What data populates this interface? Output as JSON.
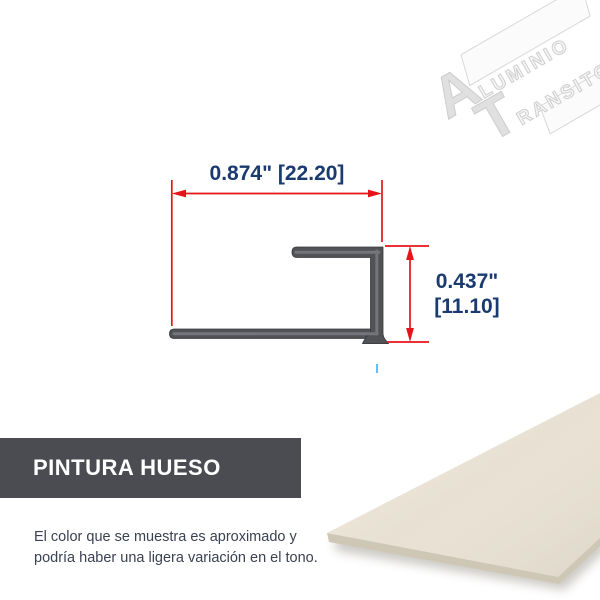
{
  "brand": {
    "name": "Aluminio Transito",
    "logo_line1_initial": "A",
    "logo_line1_rest": "LUMINIO",
    "logo_line2_initial": "T",
    "logo_line2_rest": "RANSITO",
    "registered_mark": "®",
    "watermark_color": "#dcdcdc"
  },
  "drawing": {
    "type": "profile-cross-section",
    "width_label": "0.874\" [22.20]",
    "height_label_line1": "0.437\"",
    "height_label_line2": "[11.10]",
    "dimension_color": "#e41418",
    "label_color": "#1a3a70",
    "profile_color": "#515256",
    "profile_highlight_color": "#7b7c81",
    "centerline_color": "#44b0e8"
  },
  "finish": {
    "banner_label": "PINTURA HUESO",
    "banner_color": "#4a4c52",
    "banner_text_color": "#ffffff",
    "swatch_color": "#e8e1d3",
    "swatch_edge_color": "#cfc7b5"
  },
  "disclaimer": {
    "line1": "El color que se muestra es aproximado y",
    "line2": "podría haber una ligera variación en el tono."
  }
}
